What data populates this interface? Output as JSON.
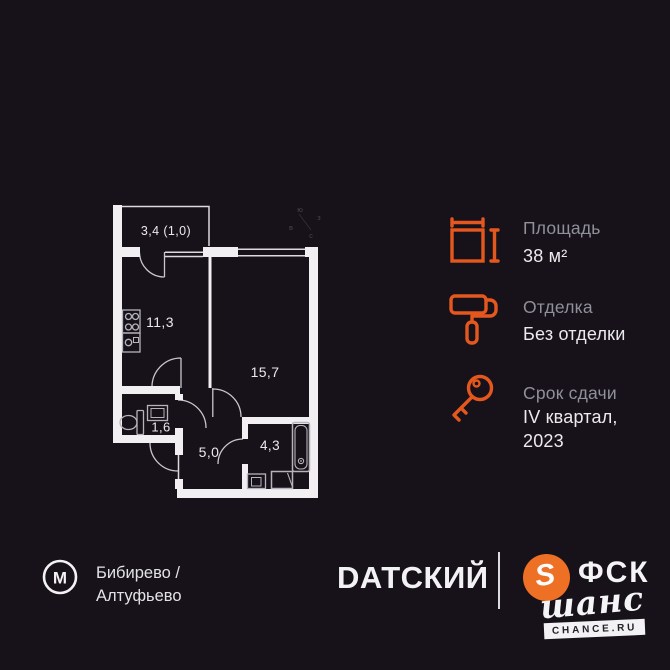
{
  "colors": {
    "background": "#171219",
    "accent_orange": "#e4571e",
    "fsk_orange": "#ed7024",
    "wall_white": "#f1eff2",
    "label_gray": "#90909a",
    "text_white": "#eceaee"
  },
  "floor_plan": {
    "rooms": {
      "balcony": "3,4 (1,0)",
      "kitchen": "11,3",
      "living": "15,7",
      "wc": "1,6",
      "hall": "5,0",
      "bath": "4,3"
    },
    "compass": {
      "south": "ю",
      "west": "з",
      "east": "в",
      "north": "с"
    }
  },
  "specs": {
    "area": {
      "icon": "area-dimensions-icon",
      "label": "Площадь",
      "value": "38 м²"
    },
    "finishing": {
      "icon": "paint-roller-icon",
      "label": "Отделка",
      "value": "Без отделки"
    },
    "deadline": {
      "icon": "key-icon",
      "label": "Срок сдачи",
      "value_line1": "IV квартал,",
      "value_line2": "2023"
    }
  },
  "footer": {
    "metro": {
      "letter": "М",
      "station_line1": "Бибирево /",
      "station_line2": "Алтуфьево"
    },
    "brand": "DАТСКИЙ",
    "developer": {
      "logo_letter": "S",
      "name": "ФСК",
      "script": "шанс",
      "site": "CHANCE.RU"
    }
  }
}
